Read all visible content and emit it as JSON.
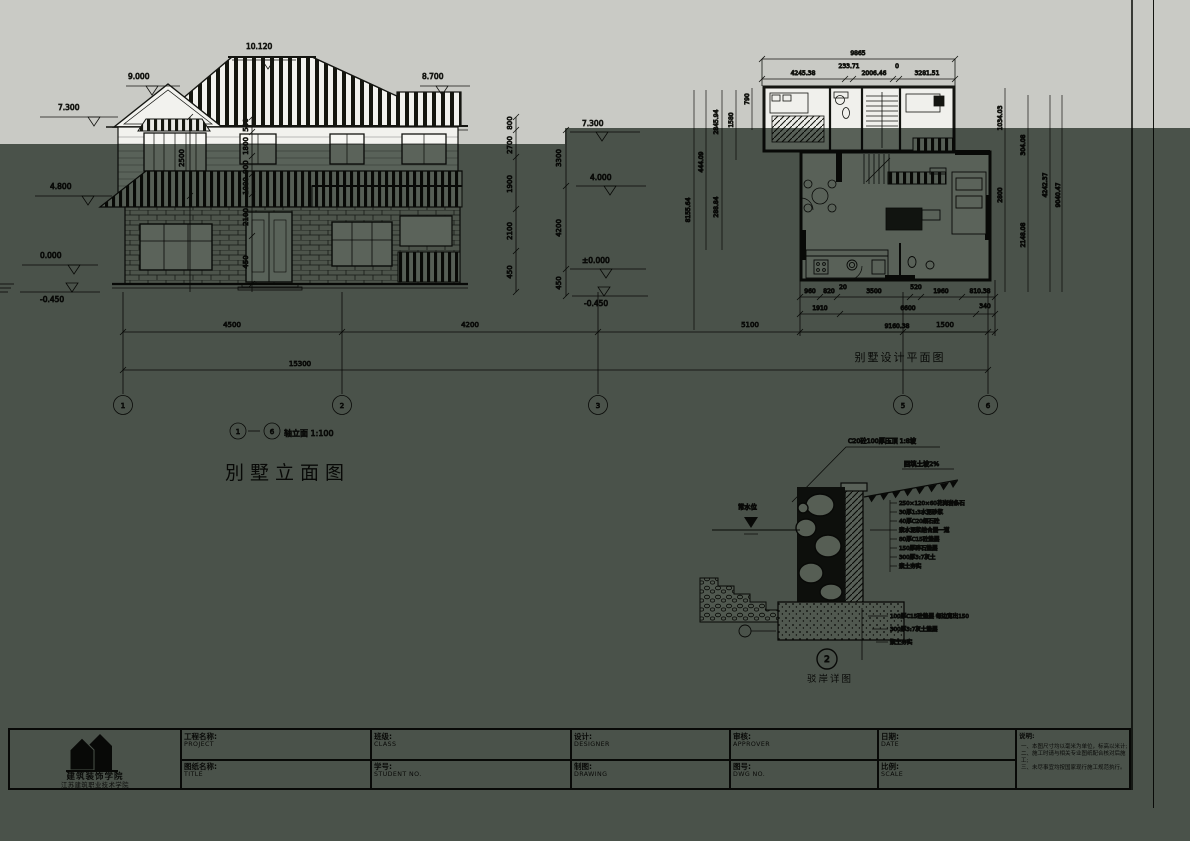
{
  "sheet": {
    "band_color": "#c9cac5",
    "overlay_color": "#5e675f",
    "ink": "#141511"
  },
  "elevation": {
    "title": "別墅立面图",
    "axis_note_start": "1",
    "axis_note_end": "6",
    "axis_note_text": "轴立面 1:100",
    "levels": {
      "ridge": "10.120",
      "gable": "9.000",
      "eave": "8.700",
      "left_top": "7.300",
      "left_mid": "4.800",
      "left_zero": "0.000",
      "left_base": "-0.450",
      "right_top": "7.300",
      "right_mid": "4.000",
      "right_zero": "±0.000",
      "right_base": "-0.450"
    },
    "dims_left_outer": [
      "2500"
    ],
    "dims_left_inner": [
      "500",
      "1800",
      "900",
      "1000",
      "2100",
      "450"
    ],
    "dims_right_inner": [
      "800",
      "2700",
      "1900",
      "2100",
      "450"
    ],
    "dims_right_outer": [
      "3300",
      "4200",
      "450"
    ],
    "dims_bottom": [
      "4500",
      "4200",
      "5100",
      "1500"
    ],
    "dim_total": "15300",
    "grid_bubbles": [
      "1",
      "2",
      "3",
      "5",
      "6"
    ]
  },
  "plan": {
    "caption": "别墅设计平面图",
    "dims_top_total": "9865",
    "dims_top": [
      "4245.38",
      "233.71",
      "2006.46",
      "0",
      "3281.51"
    ],
    "dims_left": [
      "790",
      "1580",
      "2845.94",
      "444.09",
      "8155.64",
      "288.84"
    ],
    "dims_right": [
      "1034.03",
      "2800",
      "304.08",
      "2148.08",
      "4242.37",
      "9040.47"
    ],
    "dims_bottom_row1": [
      "960",
      "820",
      "20",
      "3500",
      "520",
      "1960",
      "810.38"
    ],
    "dims_bottom_row2": [
      "1910",
      "6600",
      "340"
    ],
    "dims_bottom_total": "9160.38"
  },
  "detail": {
    "caption": "驳岸详图",
    "bubble": "2",
    "note_top": "C20砼100厚压顶 1:8坡",
    "note_slope": "回填土坡2%",
    "water_label": "常水位",
    "layers": [
      "250×120×60花岗岩条石",
      "30厚1:3水泥砂浆",
      "40厚C20细石砼",
      "素水泥浆结合层一道",
      "80厚C15砼垫层",
      "150厚碎石垫层",
      "300厚3:7灰土",
      "素土夯实"
    ],
    "footing_notes": [
      "100厚C15砼垫层 每边宽出150",
      "300厚3:7灰土垫层",
      "素土夯实"
    ]
  },
  "titleblock": {
    "logo_line1": "建筑装饰学院",
    "logo_line2": "江苏建筑职业技术学院",
    "fields": [
      {
        "cn": "工程名称:",
        "en": "PROJECT"
      },
      {
        "cn": "图纸名称:",
        "en": "TITLE"
      },
      {
        "cn": "班级:",
        "en": "CLASS"
      },
      {
        "cn": "学号:",
        "en": "STUDENT NO."
      },
      {
        "cn": "设计:",
        "en": "DESIGNER"
      },
      {
        "cn": "制图:",
        "en": "DRAWING"
      },
      {
        "cn": "审核:",
        "en": "APPROVER"
      },
      {
        "cn": "图号:",
        "en": "DWG NO."
      },
      {
        "cn": "日期:",
        "en": "DATE"
      },
      {
        "cn": "比例:",
        "en": "SCALE"
      }
    ],
    "notes_title": "说明:",
    "notes": [
      "一、本图尺寸均以毫米为单位，标高以米计;",
      "二、施工时请与相关专业图纸配合核对后施工;",
      "三、未尽事宜均按国家现行施工规范执行。"
    ]
  }
}
